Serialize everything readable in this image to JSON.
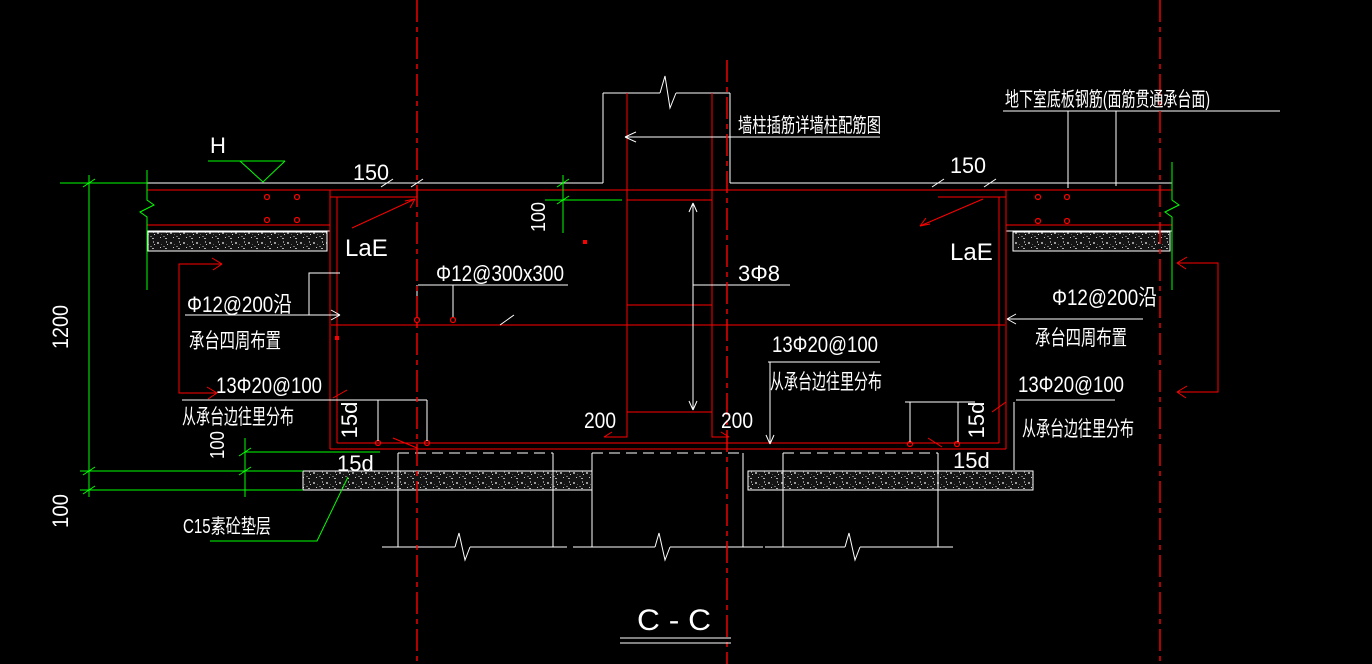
{
  "drawing": {
    "type": "structural-section-cad-drawing",
    "colors": {
      "background": "#000000",
      "line_red": "#ff0000",
      "line_green": "#00ff00",
      "line_white": "#ffffff"
    },
    "title": {
      "section_name": "C - C"
    },
    "annotations": {
      "slab_note": "地下室底板钢筋(面筋贯通承台面)",
      "wall_note": "墙柱插筋详墙柱配筋图",
      "bedding_note": "C15素砼垫层",
      "level_mark": "H",
      "anchorage": "LaE",
      "mesh_label": "Φ12@300x300",
      "tie_label": "3Φ8",
      "perimeter_label_line1": "Φ12@200沿",
      "perimeter_label_line2": "承台四周布置",
      "bottom_bar_label_line1": "13Φ20@100",
      "bottom_bar_label_line2": "从承台边往里分布",
      "hook_length": "15d"
    },
    "dimensions": {
      "d150": "150",
      "d1200": "1200",
      "d100": "100",
      "d200": "200"
    }
  }
}
